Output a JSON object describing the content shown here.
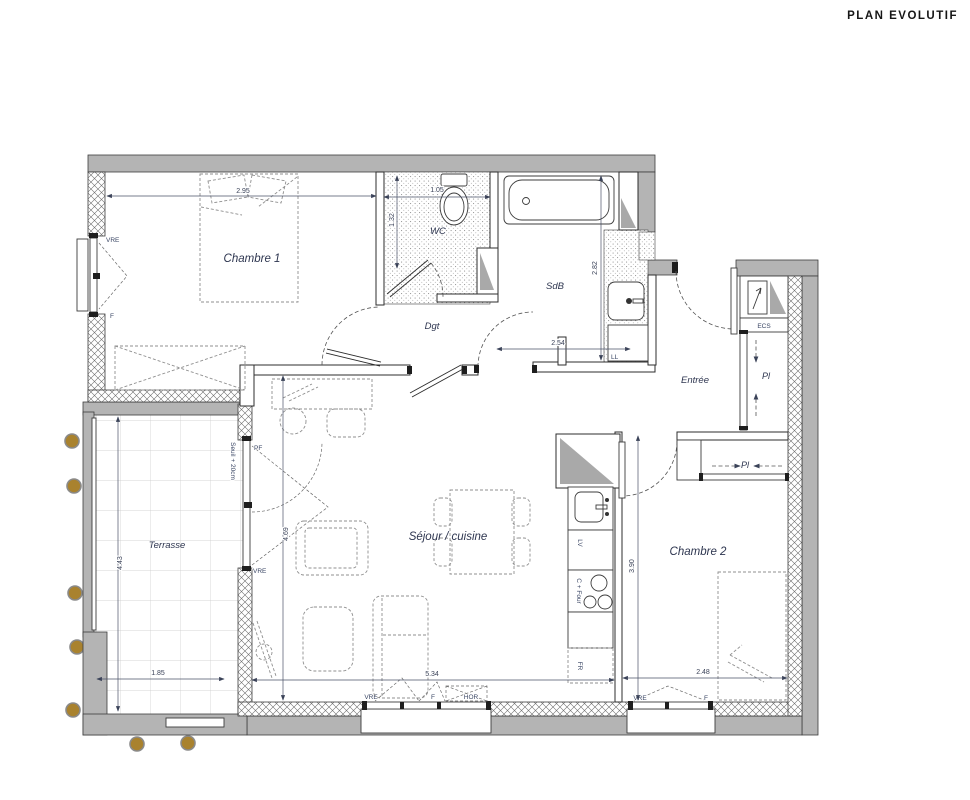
{
  "title": "PLAN EVOLUTIF",
  "rooms": {
    "chambre1": "Chambre 1",
    "wc": "WC",
    "sdb": "SdB",
    "dgt": "Dgt",
    "entree": "Entrée",
    "sejour": "Séjour / cuisine",
    "chambre2": "Chambre 2",
    "terrasse": "Terrasse"
  },
  "closets": {
    "pl_entree": "Pl",
    "pl_chambre2": "Pl",
    "ecs": "ECS",
    "ll": "LL"
  },
  "kitchen": {
    "lv": "LV",
    "cooktop": "C + Four",
    "fridge": "FR"
  },
  "dims": {
    "chambre1_w": "2.95",
    "wc_w": "1.05",
    "wc_h": "1.32",
    "sdb_h": "2.82",
    "sdb_w": "2.54",
    "sejour_h": "4.69",
    "sejour_w": "5.34",
    "chambre2_h": "3.90",
    "chambre2_w": "2.48",
    "terrasse_h": "4.43",
    "terrasse_w": "1.85",
    "seuil": "Seuil + 20cm"
  },
  "openings": {
    "chambre1_window": [
      "VRE",
      "F"
    ],
    "sejour_west": [
      "PF",
      "VRE"
    ],
    "sejour_south": [
      "VRE",
      "F",
      "HOR"
    ],
    "chambre2_south": [
      "VRE",
      "F"
    ]
  },
  "colors": {
    "wall": "#b4b4b4",
    "line": "#333333",
    "label": "#2e3650",
    "tree": "#a9822e"
  }
}
